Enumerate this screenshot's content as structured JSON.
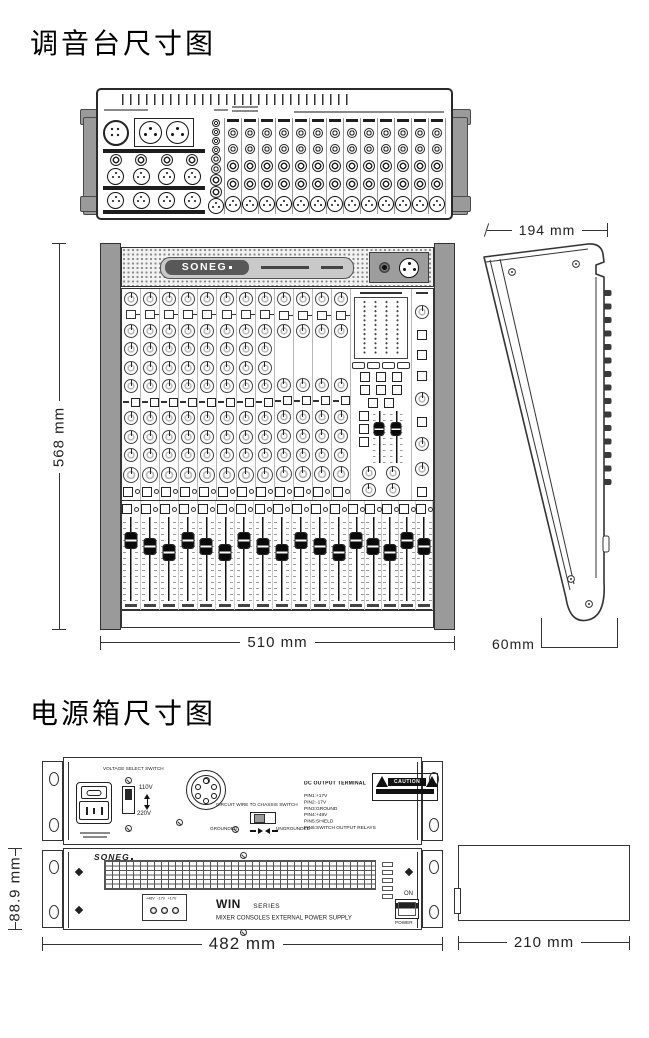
{
  "mixer_section": {
    "title": "调音台尺寸图",
    "brand": "SONEG",
    "dimensions": {
      "front_height": "568 mm",
      "front_width": "510 mm",
      "side_depth_top": "194 mm",
      "side_depth_bottom": "60mm"
    }
  },
  "psu_section": {
    "title": "电源箱尺寸图",
    "dimensions": {
      "panel_height": "88.9 mm",
      "panel_width": "482 mm",
      "depth": "210 mm"
    },
    "rear_panel": {
      "voltage_switch_label": "VOLTAGE SELECT SWITCH",
      "voltage_options": [
        "110V",
        "220V"
      ],
      "chassis_switch_label": "CIRCUIT WIRE TO CHASSIS SWITCH",
      "ground_left": "GROUNDED",
      "ground_right": "UNGROUNDED",
      "caution_label": "CAUTION",
      "dc_terminal_heading": "DC OUTPUT TERMINAL",
      "dc_pins": [
        "PIN1:+17V",
        "PIN2:-17V",
        "PIN3:GROUND",
        "PIN4:+48V",
        "PIN5:SHIELD",
        "PIN6:SWITCH OUTPUT RELAYS"
      ]
    },
    "front_panel": {
      "brand": "SONEG",
      "led_panel_labels": [
        "+48V",
        "-17V",
        "+17V"
      ],
      "model": "WIN",
      "model_suffix": "SERIES",
      "description": "MIXER CONSOLES EXTERNAL POWER SUPPLY",
      "switch_on_label": "ON",
      "switch_power_label": "POWER"
    }
  },
  "figure_hints": {
    "mixer_channels": 12,
    "rear_connector_columns": 14,
    "bottom_fader_count": 17,
    "master_meter_columns": 4,
    "side_knob_bumps": 15
  }
}
